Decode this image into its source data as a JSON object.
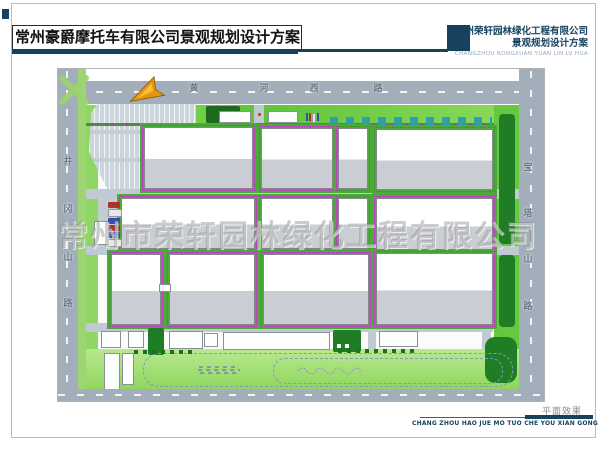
{
  "header": {
    "title": "常州豪爵摩托车有限公司景观规划设计方案",
    "firm_name": "常州荣轩园林绿化工程有限公司",
    "firm_subtitle": "景观规划设计方案",
    "firm_subtitle_en": "CHANGZHOU RONGXUAN YUAN LIN LV HUA"
  },
  "watermark": {
    "text": "常州市荣轩园林绿化工程有限公司"
  },
  "plan": {
    "roads": {
      "north": {
        "name": "黄河西路",
        "chars": [
          "黄",
          "河",
          "西",
          "路"
        ]
      },
      "west": {
        "name": "井冈山路",
        "chars": [
          "井",
          "冈",
          "山",
          "路"
        ]
      },
      "east": {
        "name": "宝塔山路",
        "chars": [
          "宝",
          "塔",
          "山",
          "路"
        ]
      }
    },
    "north_arrow": "north-arrow"
  },
  "footer": {
    "drawing_label": "平面效果",
    "caption": "CHANG ZHOU HAO JUE MO TUO CHE YOU XIAN GONG SI",
    "page_number": "09"
  },
  "colors": {
    "accent_navy": "#16425f",
    "road_gray": "#a2aeb9",
    "site_green": "#66c83e",
    "lawn_green": "#a9e27f",
    "dark_green": "#1f7d26",
    "building_gray": "#cacdd3",
    "hedge_green": "#4da83c",
    "hedge_flower_magenta": "#b03ab0",
    "shrub_cyan": "#2f9fae",
    "north_arrow_orange": "#e8940c"
  }
}
